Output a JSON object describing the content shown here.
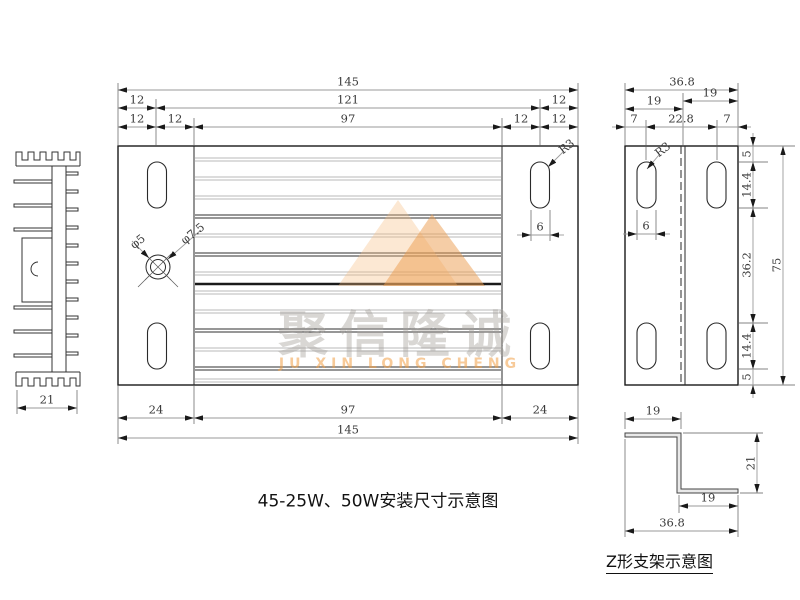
{
  "titles": {
    "main_title": "45-25W、50W安装尺寸示意图",
    "z_bracket_title": "Z形支架示意图"
  },
  "watermark": {
    "logo": "mountain-logo",
    "cn": "聚信隆诚",
    "en": "JU XIN LONG CHENG"
  },
  "main_view": {
    "top_dims": {
      "overall": "145",
      "row2": [
        "12",
        "121",
        "12"
      ],
      "row3": [
        "12",
        "12",
        "97",
        "12",
        "12"
      ]
    },
    "bottom_dims": {
      "row1": [
        "24",
        "97",
        "24"
      ],
      "overall": "145"
    },
    "hole_callouts": {
      "inner": "φ5",
      "outer": "φ7.5"
    },
    "slot_width": "6",
    "slot_radius": "R3"
  },
  "side_view": {
    "top_dims": {
      "overall": "36.8",
      "row2": [
        "19",
        "19"
      ],
      "row3": [
        "7",
        "22.8",
        "7"
      ]
    },
    "right_dims": {
      "segments": [
        "5",
        "14.4",
        "36.2",
        "14.4",
        "5"
      ],
      "overall": "75"
    },
    "slot_width": "6",
    "slot_radius": "R3"
  },
  "heatsink_profile": {
    "base_width": "21"
  },
  "z_bracket": {
    "top_flange": "19",
    "web_height": "21",
    "bottom_flange": "19",
    "overall_width": "36.8"
  },
  "colors": {
    "line": "#1a1a1a",
    "dim_line": "#9a9a9a",
    "accent_orange": "#eb9b4e",
    "watermark_gray": "#cfcbc6"
  }
}
